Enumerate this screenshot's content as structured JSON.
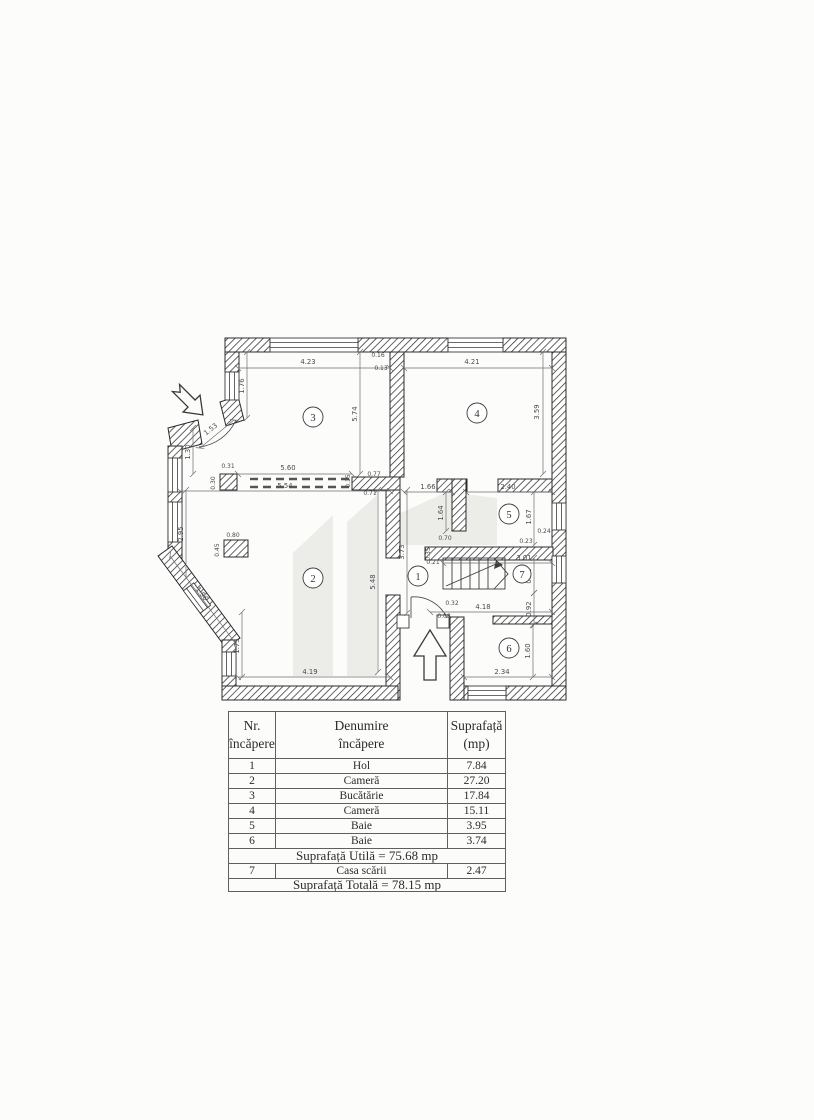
{
  "colors": {
    "ink": "#2b2b2b",
    "dimension_text": "#4a4a4a",
    "watermark": "#ecece8",
    "paper": "#fcfcfb",
    "table_border": "#5f5f5f"
  },
  "plan": {
    "rooms": [
      "1",
      "2",
      "3",
      "4",
      "5",
      "6",
      "7"
    ],
    "dims": [
      "4.23",
      "4.21",
      "5.60",
      "5.54",
      "1.66",
      "2.40",
      "3.01",
      "4.18",
      "4.19",
      "2.34",
      "1.76",
      "5.74",
      "3.59",
      "1.30",
      "2.95",
      "1.64",
      "1.67",
      "0.82",
      "0.92",
      "1.60",
      "5.48",
      "3.73",
      "1.75",
      "1.53",
      "1.56",
      "0.16",
      "0.13",
      "0.31",
      "0.15",
      "0.77",
      "0.71",
      "0.70",
      "0.24",
      "0.23",
      "0.35",
      "0.21",
      "0.80",
      "0.45",
      "0.30",
      "0.08",
      "0.32"
    ]
  },
  "table": {
    "header": {
      "nr1": "Nr.",
      "nr2": "încăpere",
      "den1": "Denumire",
      "den2": "încăpere",
      "sup1": "Suprafață",
      "sup2": "(mp)"
    },
    "rows": [
      {
        "nr": "1",
        "den": "Hol",
        "mp": "7.84"
      },
      {
        "nr": "2",
        "den": "Cameră",
        "mp": "27.20"
      },
      {
        "nr": "3",
        "den": "Bucătărie",
        "mp": "17.84"
      },
      {
        "nr": "4",
        "den": "Cameră",
        "mp": "15.11"
      },
      {
        "nr": "5",
        "den": "Baie",
        "mp": "3.95"
      },
      {
        "nr": "6",
        "den": "Baie",
        "mp": "3.74"
      }
    ],
    "utila": "Suprafață Utilă = 75.68 mp",
    "row7": {
      "nr": "7",
      "den": "Casa scării",
      "mp": "2.47"
    },
    "totala": "Suprafață Totală = 78.15 mp"
  }
}
